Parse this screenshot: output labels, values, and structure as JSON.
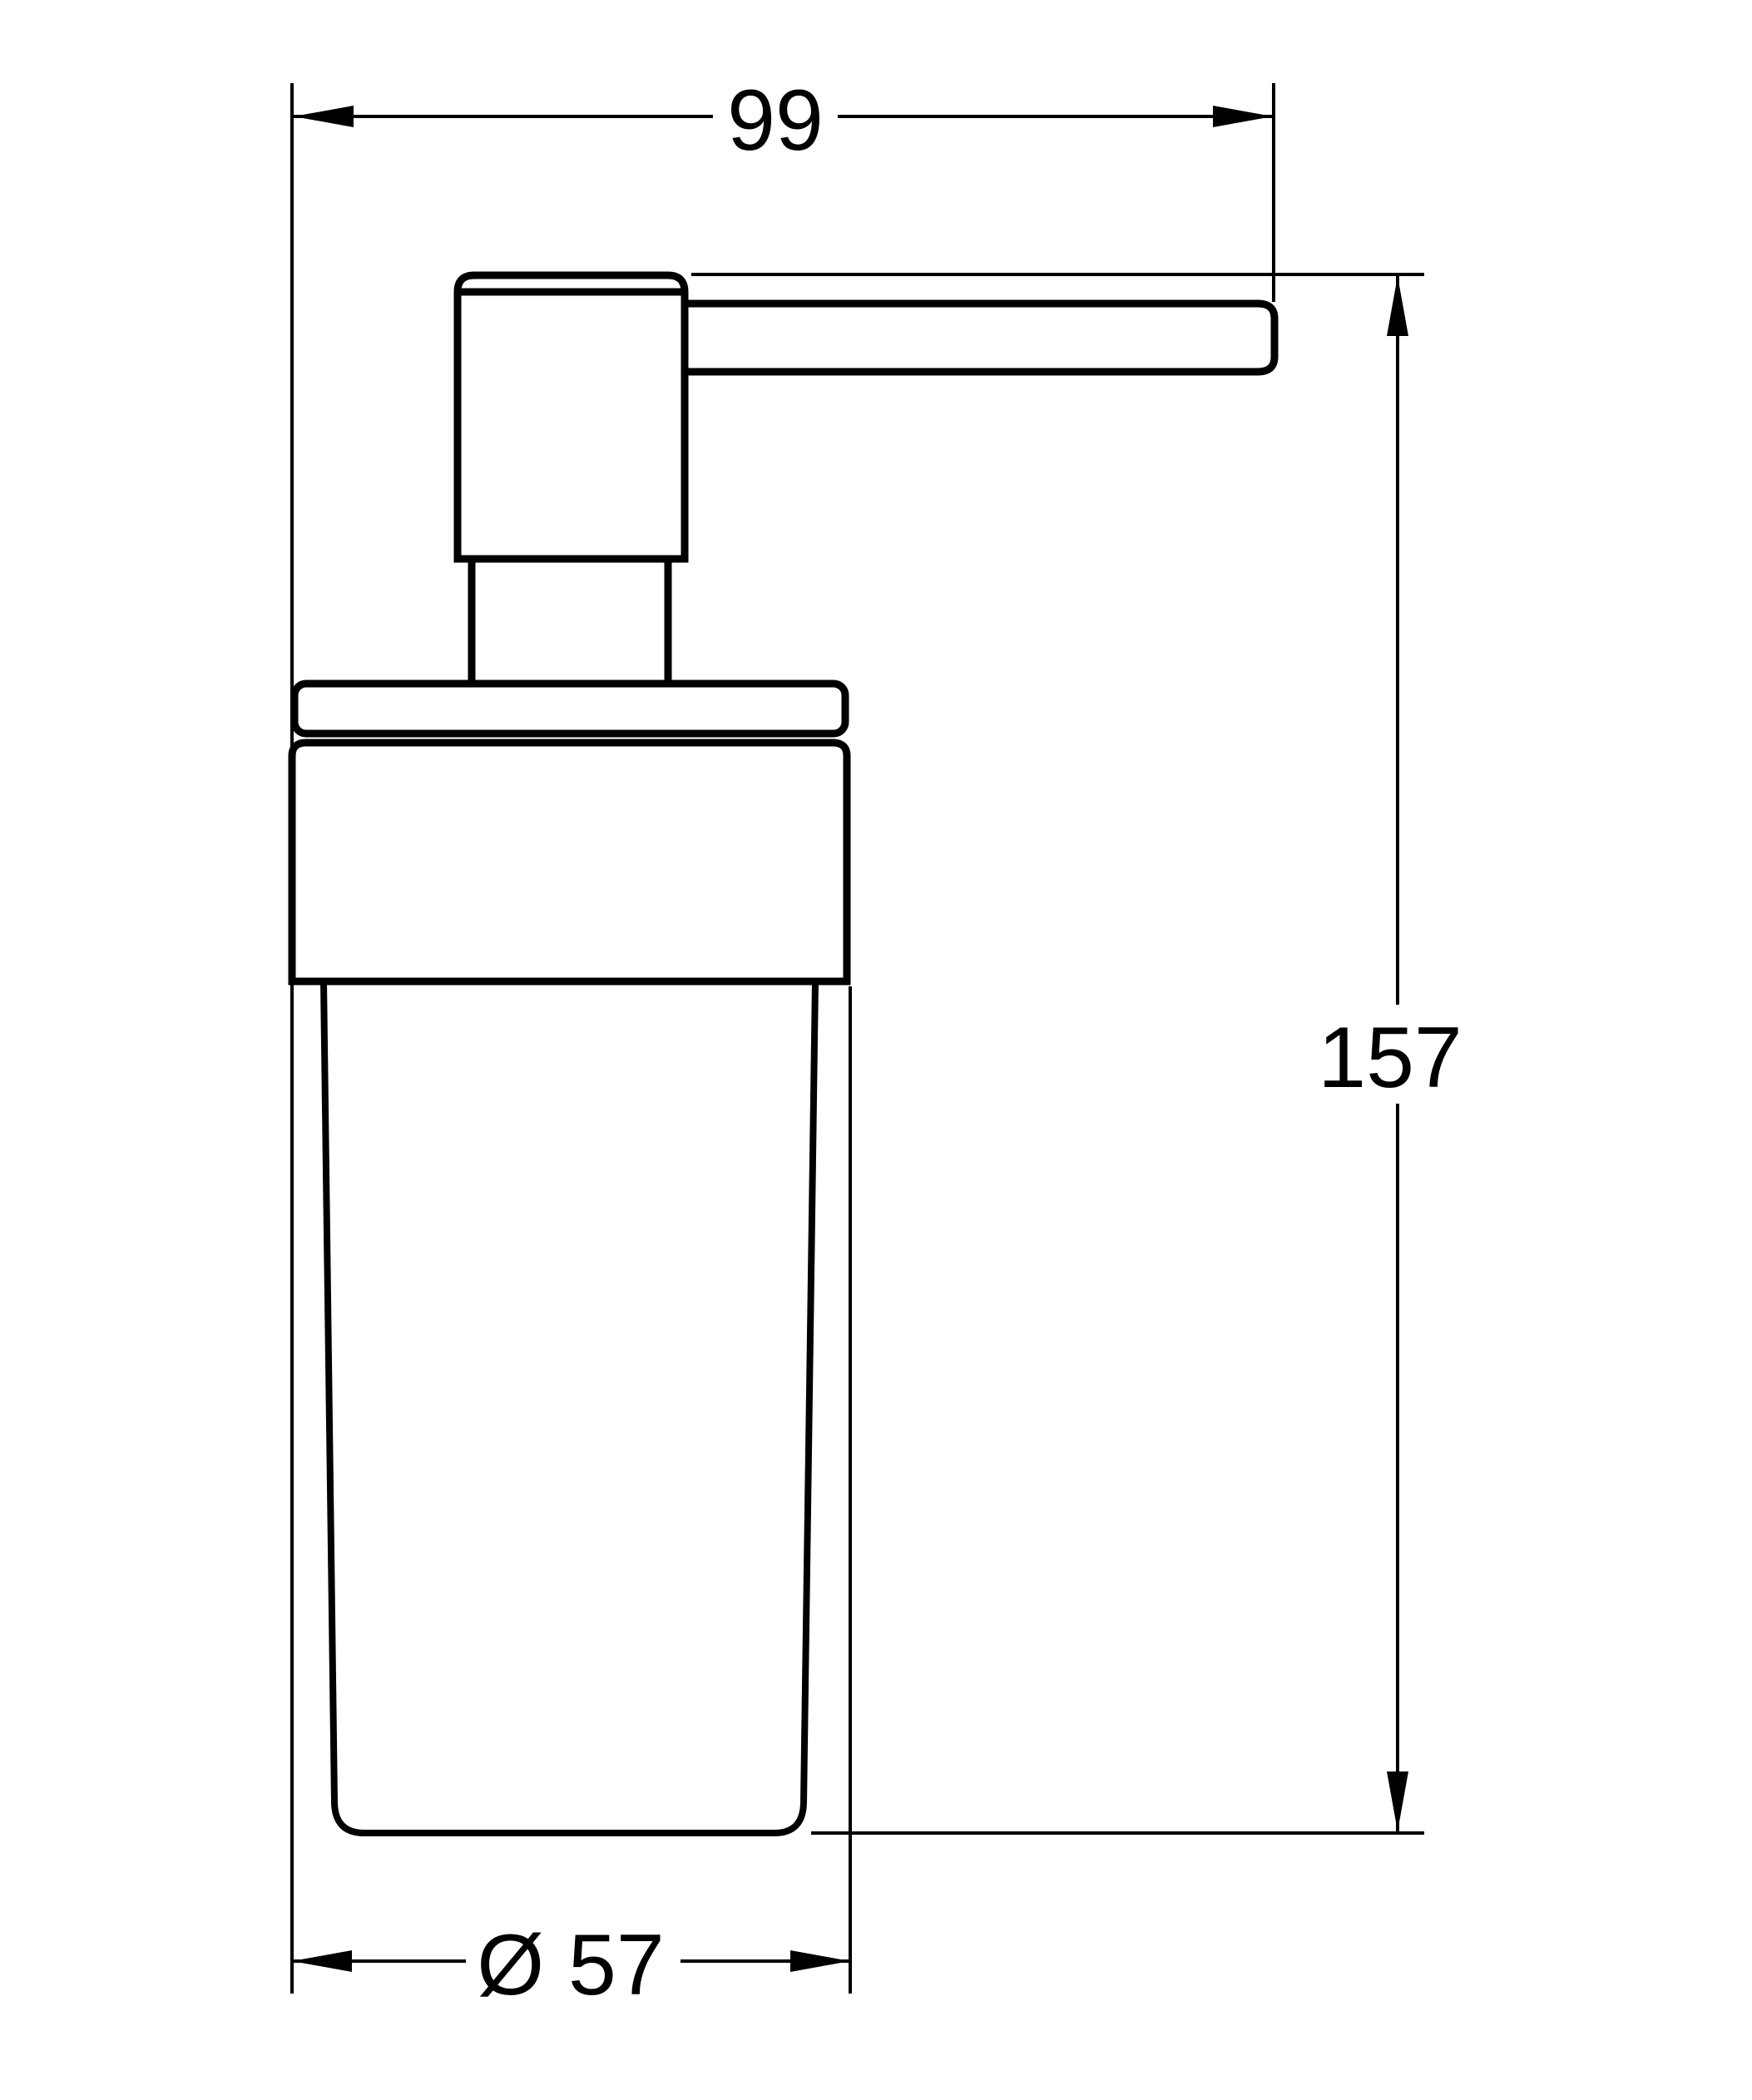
{
  "canvas": {
    "background": "#ffffff",
    "line_color": "#000000"
  },
  "subject": {
    "name": "soap-dispenser-side-view",
    "view": "technical line drawing with dimension annotations"
  },
  "annotations": {
    "top_width": {
      "label": "99",
      "orientation": "horizontal",
      "position": "top"
    },
    "right_height": {
      "label": "157",
      "orientation": "vertical",
      "position": "right"
    },
    "bottom_diameter": {
      "label": "Ø 57",
      "orientation": "horizontal",
      "position": "bottom"
    }
  }
}
